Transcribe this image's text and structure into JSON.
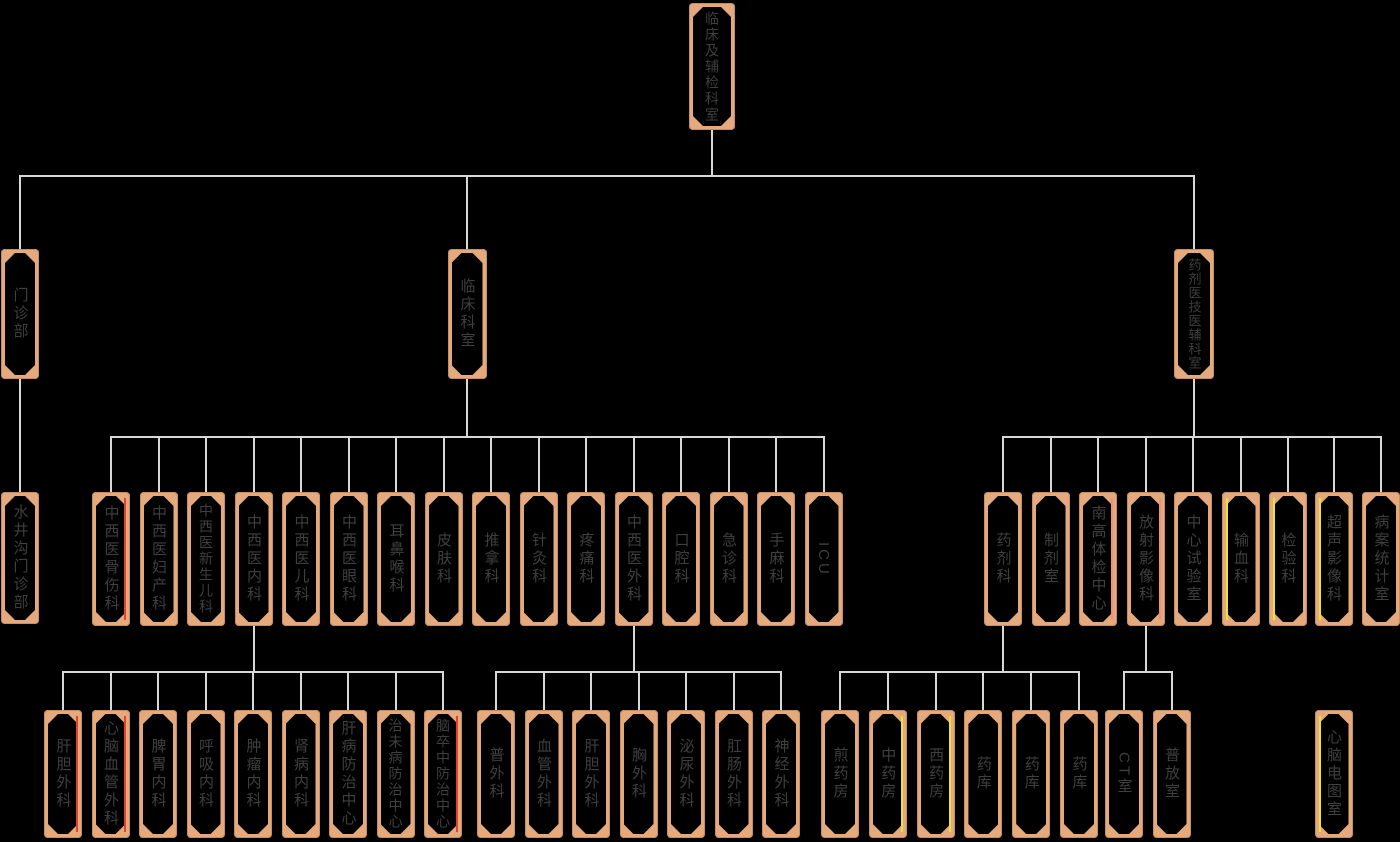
{
  "diagram": {
    "type": "org-chart",
    "background": "#000000",
    "node_frame_color": "#E4A97C",
    "node_fill_color": "#000000",
    "node_text_color": "#3F3F3F",
    "connector_color": "#D8D8D8",
    "accent_colors": {
      "red": "#E5402A",
      "yellow": "#E8E337",
      "salmon": "#F0907A"
    },
    "tree": {
      "label": "临床及辅检科室",
      "x": 712,
      "y": 3,
      "w": 46,
      "h": 127,
      "bus_y": 176,
      "children": [
        {
          "label": "门诊部",
          "x": 20,
          "y": 249,
          "w": 38,
          "h": 130,
          "bus_y": 437,
          "children": [
            {
              "label": "水井沟门诊部",
              "x": 20,
              "y": 492,
              "w": 38,
              "h": 132
            }
          ]
        },
        {
          "label": "临床科室",
          "x": 467,
          "y": 249,
          "w": 39,
          "h": 130,
          "bus_y": 437,
          "children": [
            {
              "label": "中西医骨伤科",
              "x": 111,
              "y": 492,
              "w": 38,
              "h": 134,
              "accent": "red-right"
            },
            {
              "label": "中西医妇产科",
              "x": 158.5,
              "y": 492,
              "w": 38,
              "h": 134
            },
            {
              "label": "中西医新生儿科",
              "x": 206,
              "y": 492,
              "w": 38,
              "h": 134
            },
            {
              "label": "中西医内科",
              "x": 253.5,
              "y": 492,
              "w": 38,
              "h": 134,
              "bus_y": 672,
              "children": [
                {
                  "label": "肝胆外科",
                  "x": 63,
                  "y": 710,
                  "w": 38,
                  "h": 128,
                  "accent": "red-right"
                },
                {
                  "label": "心脑血管外科",
                  "x": 110.5,
                  "y": 710,
                  "w": 38,
                  "h": 128,
                  "accent": "red-right"
                },
                {
                  "label": "脾胃内科",
                  "x": 158,
                  "y": 710,
                  "w": 38,
                  "h": 128
                },
                {
                  "label": "呼吸内科",
                  "x": 205.5,
                  "y": 710,
                  "w": 38,
                  "h": 128
                },
                {
                  "label": "肿瘤内科",
                  "x": 253,
                  "y": 710,
                  "w": 38,
                  "h": 128
                },
                {
                  "label": "肾病内科",
                  "x": 300.5,
                  "y": 710,
                  "w": 38,
                  "h": 128
                },
                {
                  "label": "肝病防治中心",
                  "x": 348,
                  "y": 710,
                  "w": 38,
                  "h": 128
                },
                {
                  "label": "治未病防治中心",
                  "x": 395.5,
                  "y": 710,
                  "w": 38,
                  "h": 128
                },
                {
                  "label": "脑卒中防治中心",
                  "x": 443,
                  "y": 710,
                  "w": 38,
                  "h": 128,
                  "accent": "red-right"
                }
              ]
            },
            {
              "label": "中西医儿科",
              "x": 301,
              "y": 492,
              "w": 38,
              "h": 134
            },
            {
              "label": "中西医眼科",
              "x": 348.5,
              "y": 492,
              "w": 38,
              "h": 134
            },
            {
              "label": "耳鼻喉科",
              "x": 396,
              "y": 492,
              "w": 38,
              "h": 134
            },
            {
              "label": "皮肤科",
              "x": 443.5,
              "y": 492,
              "w": 38,
              "h": 134
            },
            {
              "label": "推拿科",
              "x": 491,
              "y": 492,
              "w": 38,
              "h": 134
            },
            {
              "label": "针灸科",
              "x": 538.5,
              "y": 492,
              "w": 38,
              "h": 134
            },
            {
              "label": "疼痛科",
              "x": 586,
              "y": 492,
              "w": 38,
              "h": 134
            },
            {
              "label": "中西医外科",
              "x": 633.5,
              "y": 492,
              "w": 38,
              "h": 134,
              "bus_y": 672,
              "children": [
                {
                  "label": "普外科",
                  "x": 496,
                  "y": 710,
                  "w": 38,
                  "h": 128
                },
                {
                  "label": "血管外科",
                  "x": 543.5,
                  "y": 710,
                  "w": 38,
                  "h": 128
                },
                {
                  "label": "肝胆外科",
                  "x": 591,
                  "y": 710,
                  "w": 38,
                  "h": 128
                },
                {
                  "label": "胸外科",
                  "x": 638.5,
                  "y": 710,
                  "w": 38,
                  "h": 128
                },
                {
                  "label": "泌尿外科",
                  "x": 686,
                  "y": 710,
                  "w": 38,
                  "h": 128
                },
                {
                  "label": "肛肠外科",
                  "x": 733.5,
                  "y": 710,
                  "w": 38,
                  "h": 128
                },
                {
                  "label": "神经外科",
                  "x": 781,
                  "y": 710,
                  "w": 38,
                  "h": 128
                }
              ]
            },
            {
              "label": "口腔科",
              "x": 681,
              "y": 492,
              "w": 38,
              "h": 134
            },
            {
              "label": "急诊科",
              "x": 728.5,
              "y": 492,
              "w": 38,
              "h": 134
            },
            {
              "label": "手麻科",
              "x": 776,
              "y": 492,
              "w": 38,
              "h": 134
            },
            {
              "label": "ICU",
              "x": 823.5,
              "y": 492,
              "w": 38,
              "h": 134
            }
          ]
        },
        {
          "label": "药剂医技医辅科室",
          "x": 1194,
          "y": 249,
          "w": 40,
          "h": 130,
          "bus_y": 437,
          "children": [
            {
              "label": "药剂科",
              "x": 1003,
              "y": 492,
              "w": 38,
              "h": 134,
              "bus_y": 672,
              "children": [
                {
                  "label": "煎药房",
                  "x": 840,
                  "y": 710,
                  "w": 38,
                  "h": 128
                },
                {
                  "label": "中药房",
                  "x": 887.8,
                  "y": 710,
                  "w": 38,
                  "h": 128,
                  "accent": "yellow-right"
                },
                {
                  "label": "西药房",
                  "x": 935.6,
                  "y": 710,
                  "w": 38,
                  "h": 128,
                  "accent": "yellow-right"
                },
                {
                  "label": "药库",
                  "x": 983.4,
                  "y": 710,
                  "w": 38,
                  "h": 128
                },
                {
                  "label": "药库",
                  "x": 1031.2,
                  "y": 710,
                  "w": 38,
                  "h": 128
                },
                {
                  "label": "药库",
                  "x": 1079,
                  "y": 710,
                  "w": 38,
                  "h": 128
                }
              ]
            },
            {
              "label": "制剂室",
              "x": 1050.5,
              "y": 492,
              "w": 38,
              "h": 134
            },
            {
              "label": "南高体检中心",
              "x": 1098,
              "y": 492,
              "w": 38,
              "h": 134,
              "accent": "salmon-right"
            },
            {
              "label": "放射影像科",
              "x": 1145.5,
              "y": 492,
              "w": 38,
              "h": 134,
              "bus_y": 672,
              "accent": "salmon-right",
              "children": [
                {
                  "label": "CT室",
                  "x": 1124,
                  "y": 710,
                  "w": 38,
                  "h": 128
                },
                {
                  "label": "普放室",
                  "x": 1171.5,
                  "y": 710,
                  "w": 38,
                  "h": 128
                }
              ]
            },
            {
              "label": "中心试验室",
              "x": 1193,
              "y": 492,
              "w": 38,
              "h": 134
            },
            {
              "label": "输血科",
              "x": 1240.5,
              "y": 492,
              "w": 38,
              "h": 134,
              "accent": "yellow-left"
            },
            {
              "label": "检验科",
              "x": 1288,
              "y": 492,
              "w": 38,
              "h": 134,
              "accent": "yellow-left"
            },
            {
              "label": "超声影像科",
              "x": 1333.5,
              "y": 492,
              "w": 38,
              "h": 134,
              "accent": "yellow-left",
              "children": [
                {
                  "label": "心脑电图室",
                  "x": 1333.5,
                  "y": 710,
                  "w": 38,
                  "h": 128,
                  "accent": "yellow-left"
                }
              ]
            },
            {
              "label": "病案统计室",
              "x": 1381,
              "y": 492,
              "w": 38,
              "h": 134
            }
          ]
        }
      ]
    }
  }
}
